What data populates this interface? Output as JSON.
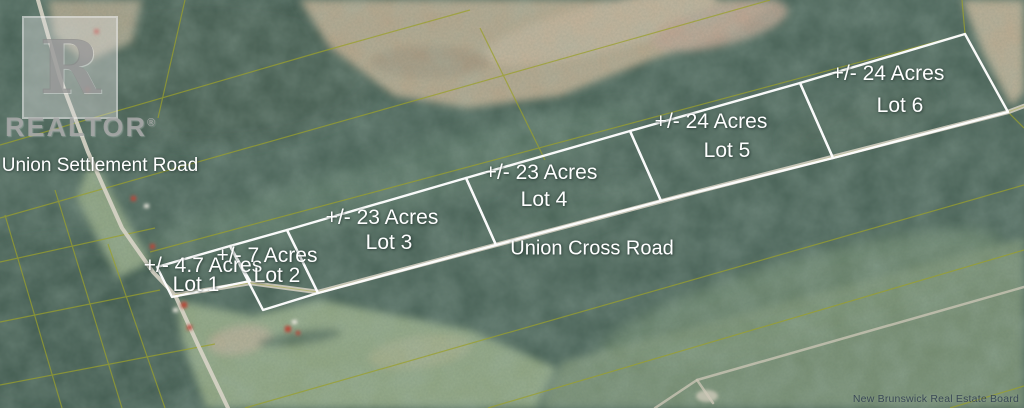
{
  "watermark": {
    "letter": "R",
    "word": "REALTOR",
    "registered": "®"
  },
  "roads": {
    "settlement_label": "Union Settlement Road",
    "cross_label": "Union Cross Road"
  },
  "lots": [
    {
      "name": "Lot 1",
      "size_label": "+/- 4.7 Acres",
      "acres": 4.7
    },
    {
      "name": "Lot 2",
      "size_label": "+/- 7 Acres",
      "acres": 7
    },
    {
      "name": "Lot 3",
      "size_label": "+/- 23 Acres",
      "acres": 23
    },
    {
      "name": "Lot 4",
      "size_label": "+/- 23 Acres",
      "acres": 23
    },
    {
      "name": "Lot 5",
      "size_label": "+/- 24 Acres",
      "acres": 24
    },
    {
      "name": "Lot 6",
      "size_label": "+/- 24 Acres",
      "acres": 24
    }
  ],
  "attribution": "New Brunswick Real Estate Board",
  "colors": {
    "lot_boundary": "#ffffff",
    "cadastral_line": "#9aa02c",
    "forest": "#486156",
    "field": "#7b9174",
    "cleared": "#b9a78c",
    "road": "#d8d4c6"
  }
}
